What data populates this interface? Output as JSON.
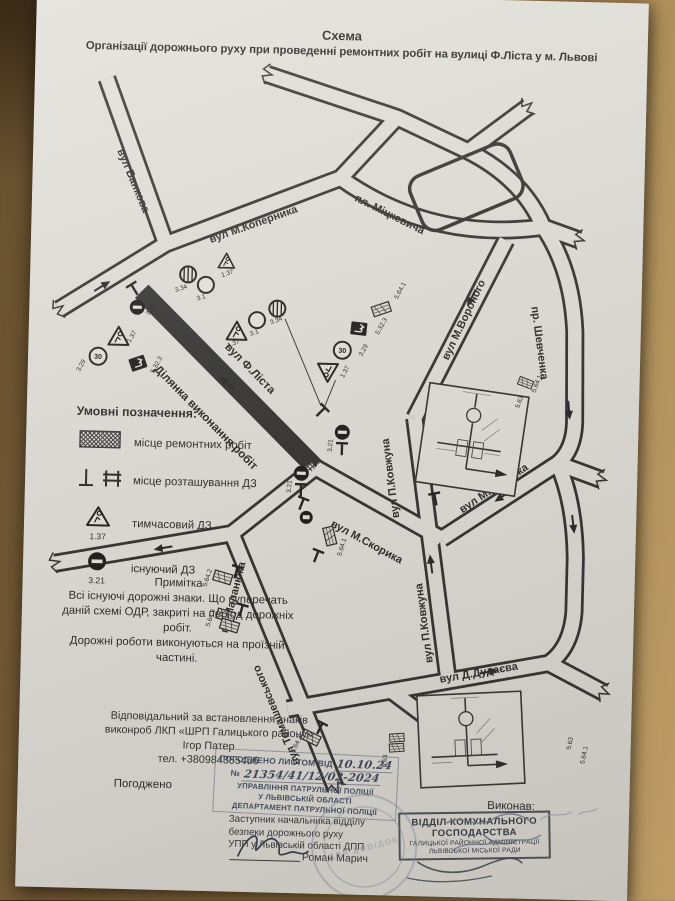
{
  "colors": {
    "paper": "#e1dfda",
    "ink": "#2d2d2d",
    "stamp_ink": "#3d4a63",
    "wood": "#96763f"
  },
  "title": {
    "line1": "Схема",
    "line2": "Організації дорожнього руху при проведенні ремонтних робіт на вулиці Ф.Ліста у м. Львові"
  },
  "map": {
    "streets": {
      "bankova": "вул Банкова",
      "kopernyka": "вул М.Коперника",
      "mitskevycha": "пл. Міцкевича",
      "voronoho": "вул М.Вороного",
      "shevchenka": "пр. Шевченка",
      "lista": "вул Ф.Ліста",
      "dilyanka": "Ділянка виконання робіт",
      "kovzhuna": "вул П.Ковжуна",
      "skoryka": "вул М.Скорика",
      "malanyuka": "пл.Маланюка",
      "tomashevskoho": "вул Томашевського",
      "dudayeva": "вул Д.Дудаєва"
    },
    "signs": {
      "s30": "30",
      "s329": "3.29",
      "s137": "1.37",
      "s5323": "5.32.3",
      "s5641": "5.64.1",
      "s5642": "5.64.2",
      "s5643": "5.64.3",
      "s321": "3.21",
      "s31": "3.1",
      "s334": "3.34",
      "s563": "5.63"
    }
  },
  "legend": {
    "heading": "Умовні позначення:",
    "items": [
      {
        "label": "місце ремонтних робіт"
      },
      {
        "label": "місце розташування ДЗ"
      },
      {
        "code": "1.37",
        "label": "тимчасовий ДЗ"
      },
      {
        "code": "3.21",
        "label": "існуючий ДЗ"
      }
    ]
  },
  "note": {
    "heading": "Примітка",
    "body1": "Всі існуючі дорожні знаки. Що суперечать даній схемі ОДР, закриті на період дорожніх робіт.",
    "body2": "Дорожні роботи виконуються на проїзній частині."
  },
  "responsible": {
    "line1": "Відповідальний за встановлення знаків",
    "line2": "виконроб ЛКП «ШРП Галицького району»",
    "line3": "Ігор Патер",
    "line4": "тел. +380984355456"
  },
  "approval": {
    "agreed_label": "Погоджено",
    "executed_label": "Виконав:",
    "police_stamp": {
      "l1": "ПОГОДЖЕНО ЛИСТОМ ВІД",
      "date": "10.10.24",
      "no": "№",
      "number": "21354/41/12/02-2024",
      "org1": "УПРАВЛІННЯ ПАТРУЛЬНОЇ ПОЛІЦІЇ",
      "org2": "У ЛЬВІВСЬКІЙ ОБЛАСТІ",
      "org3": "ДЕПАРТАМЕНТ ПАТРУЛЬНОЇ ПОЛІЦІЇ"
    },
    "signer_position": {
      "l1": "Заступник начальника відділу",
      "l2": "безпеки дорожнього руху",
      "l3": "УПП у Львівській області ДПП"
    },
    "signer_name": "Роман Марич",
    "round_stamp": "ДЛЯ ДОВІДОК",
    "dept_stamp": {
      "l1": "ВІДДІЛ КОМУНАЛЬНОГО",
      "l2": "ГОСПОДАРСТВА",
      "l3": "ГАЛИЦЬКОЇ РАЙОННОЇ АДМІНІСТРАЦІЇ",
      "l4": "ЛЬВІВСЬКОЇ МІСЬКОЇ РАДИ"
    }
  }
}
